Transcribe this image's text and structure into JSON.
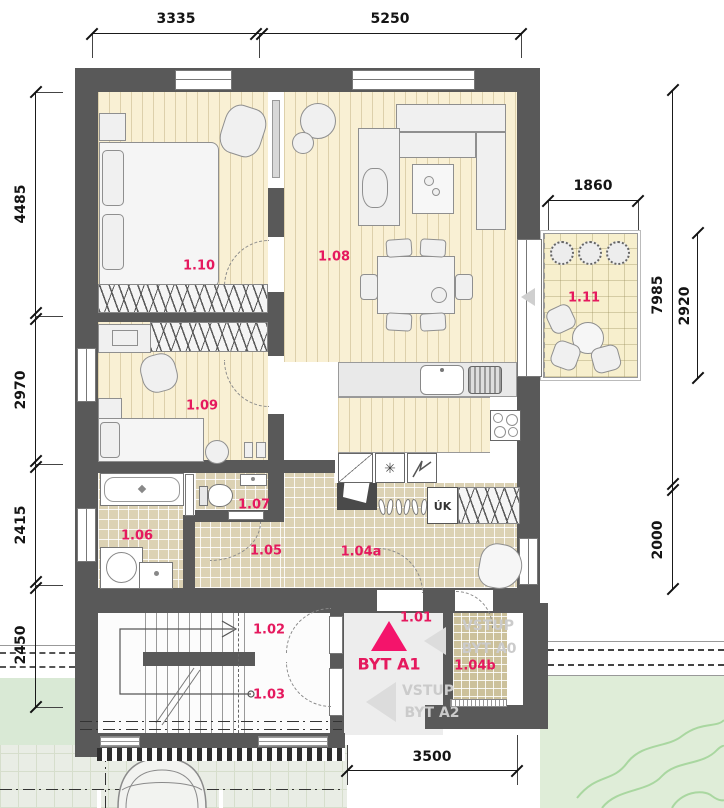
{
  "plan_title": "BYT A1",
  "rooms": {
    "r101": "1.01",
    "r102": "1.02",
    "r103": "1.03",
    "r104a": "1.04a",
    "r104b": "1.04b",
    "r105": "1.05",
    "r106": "1.06",
    "r107": "1.07",
    "r108": "1.08",
    "r109": "1.09",
    "r110": "1.10",
    "r111": "1.11"
  },
  "entrances": {
    "a0_line1": "VSTUP",
    "a0_line2": "BYT A0",
    "a2_line1": "VSTUP",
    "a2_line2": "BYT A2"
  },
  "kitchen": {
    "cabinet_label": "ÚK",
    "freezer_symbol": "✳"
  },
  "dimensions": {
    "top_left": "3335",
    "top_right": "5250",
    "terrace_width": "1860",
    "terrace_height": "2920",
    "right_main": "7985",
    "right_lower": "2000",
    "left_1": "4485",
    "left_2": "2970",
    "left_3": "2415",
    "left_4": "2450",
    "bottom": "3500"
  },
  "colors": {
    "accent": "#E5195E",
    "wall": "#595959",
    "wood_floor": "#F9F0D4",
    "tile_floor": "#DCD2B4",
    "terrace_floor": "#F7EFCD",
    "lawn": "#DFEDD8"
  }
}
